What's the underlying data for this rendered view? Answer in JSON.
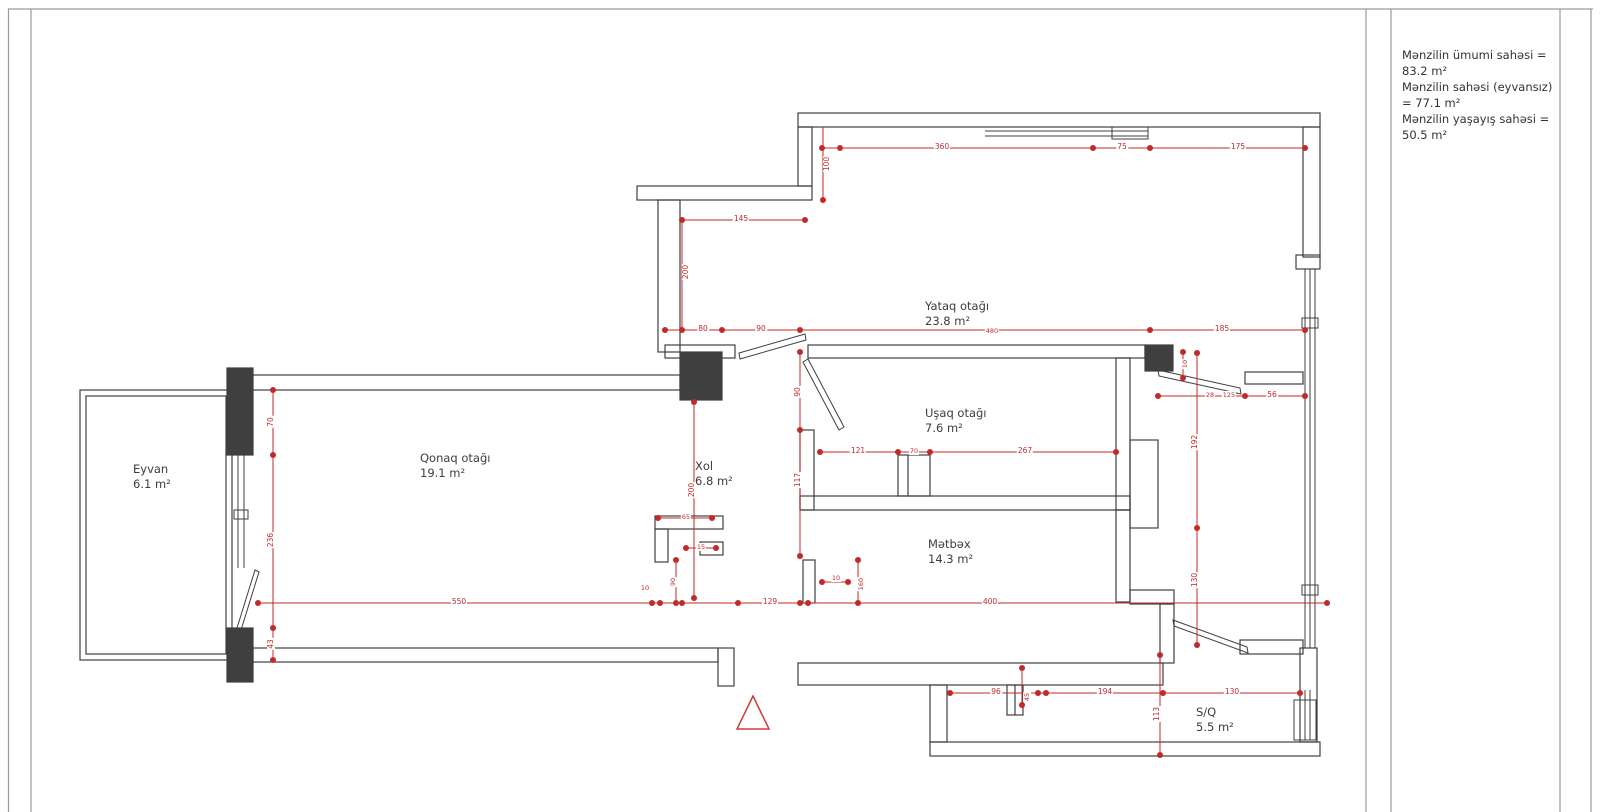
{
  "sheet": {
    "background": "#ffffff",
    "wall_color": "#3f3f3f",
    "dimension_color": "#c22a2a"
  },
  "summary_panel": {
    "lines": [
      "Mənzilin ümumi sahəsi = 83.2 m²",
      "Mənzilin sahəsi (eyvansız) = 77.1 m²",
      "Mənzilin yaşayış sahəsi = 50.5 m²"
    ]
  },
  "floorplan": {
    "north_symbol": "triangle",
    "rooms": [
      {
        "id": "eyvan",
        "name": "Eyvan",
        "area": "6.1 m²",
        "x": 133,
        "y": 462
      },
      {
        "id": "qonaq-otagi",
        "name": "Qonaq otağı",
        "area": "19.1 m²",
        "x": 420,
        "y": 451
      },
      {
        "id": "xol",
        "name": "Xol",
        "area": "6.8 m²",
        "x": 695,
        "y": 459
      },
      {
        "id": "yataq-otagi",
        "name": "Yataq otağı",
        "area": "23.8 m²",
        "x": 925,
        "y": 299
      },
      {
        "id": "usaq-otagi",
        "name": "Uşaq otağı",
        "area": "7.6 m²",
        "x": 925,
        "y": 406
      },
      {
        "id": "metbex",
        "name": "Mətbəx",
        "area": "14.3 m²",
        "x": 928,
        "y": 537
      },
      {
        "id": "s-q",
        "name": "S/Q",
        "area": "5.5 m²",
        "x": 1196,
        "y": 705
      }
    ],
    "dimensions": [
      {
        "t": "100",
        "x": 827,
        "y": 164,
        "o": "v"
      },
      {
        "t": "360",
        "x": 942,
        "y": 147,
        "o": "h"
      },
      {
        "t": "75",
        "x": 1122,
        "y": 147,
        "o": "h"
      },
      {
        "t": "175",
        "x": 1238,
        "y": 147,
        "o": "h"
      },
      {
        "t": "145",
        "x": 741,
        "y": 219,
        "o": "h"
      },
      {
        "t": "200",
        "x": 686,
        "y": 272,
        "o": "v"
      },
      {
        "t": "80",
        "x": 703,
        "y": 329,
        "o": "h"
      },
      {
        "t": "90",
        "x": 761,
        "y": 329,
        "o": "h"
      },
      {
        "t": "480",
        "x": 992,
        "y": 331,
        "o": "h",
        "s": 1
      },
      {
        "t": "185",
        "x": 1222,
        "y": 329,
        "o": "h"
      },
      {
        "t": "10",
        "x": 1185,
        "y": 364,
        "o": "v",
        "s": 1
      },
      {
        "t": "28",
        "x": 1210,
        "y": 395,
        "o": "h",
        "s": 1
      },
      {
        "t": "125",
        "x": 1229,
        "y": 395,
        "o": "h",
        "s": 1
      },
      {
        "t": "56",
        "x": 1272,
        "y": 395,
        "o": "h"
      },
      {
        "t": "90",
        "x": 798,
        "y": 392,
        "o": "v"
      },
      {
        "t": "117",
        "x": 798,
        "y": 480,
        "o": "v"
      },
      {
        "t": "121",
        "x": 858,
        "y": 451,
        "o": "h"
      },
      {
        "t": "70",
        "x": 914,
        "y": 451,
        "o": "h",
        "s": 1
      },
      {
        "t": "267",
        "x": 1025,
        "y": 451,
        "o": "h"
      },
      {
        "t": "192",
        "x": 1195,
        "y": 442,
        "o": "v"
      },
      {
        "t": "130",
        "x": 1195,
        "y": 580,
        "o": "v"
      },
      {
        "t": "200",
        "x": 692,
        "y": 490,
        "o": "v"
      },
      {
        "t": "70",
        "x": 271,
        "y": 422,
        "o": "v"
      },
      {
        "t": "236",
        "x": 271,
        "y": 540,
        "o": "v"
      },
      {
        "t": "43",
        "x": 271,
        "y": 644,
        "o": "v"
      },
      {
        "t": "550",
        "x": 459,
        "y": 602,
        "o": "h"
      },
      {
        "t": "129",
        "x": 770,
        "y": 602,
        "o": "h"
      },
      {
        "t": "400",
        "x": 990,
        "y": 602,
        "o": "h"
      },
      {
        "t": "65",
        "x": 686,
        "y": 517,
        "o": "h",
        "s": 1
      },
      {
        "t": "15",
        "x": 701,
        "y": 547,
        "o": "h",
        "s": 1
      },
      {
        "t": "90",
        "x": 673,
        "y": 582,
        "o": "v",
        "s": 1
      },
      {
        "t": "10",
        "x": 645,
        "y": 588,
        "o": "h",
        "s": 1
      },
      {
        "t": "10",
        "x": 836,
        "y": 578,
        "o": "h",
        "s": 1
      },
      {
        "t": "160",
        "x": 861,
        "y": 584,
        "o": "v",
        "s": 1
      },
      {
        "t": "96",
        "x": 996,
        "y": 692,
        "o": "h"
      },
      {
        "t": "194",
        "x": 1105,
        "y": 692,
        "o": "h"
      },
      {
        "t": "130",
        "x": 1232,
        "y": 692,
        "o": "h"
      },
      {
        "t": "113",
        "x": 1157,
        "y": 714,
        "o": "v"
      },
      {
        "t": "45",
        "x": 1027,
        "y": 697,
        "o": "v",
        "s": 1
      }
    ]
  }
}
